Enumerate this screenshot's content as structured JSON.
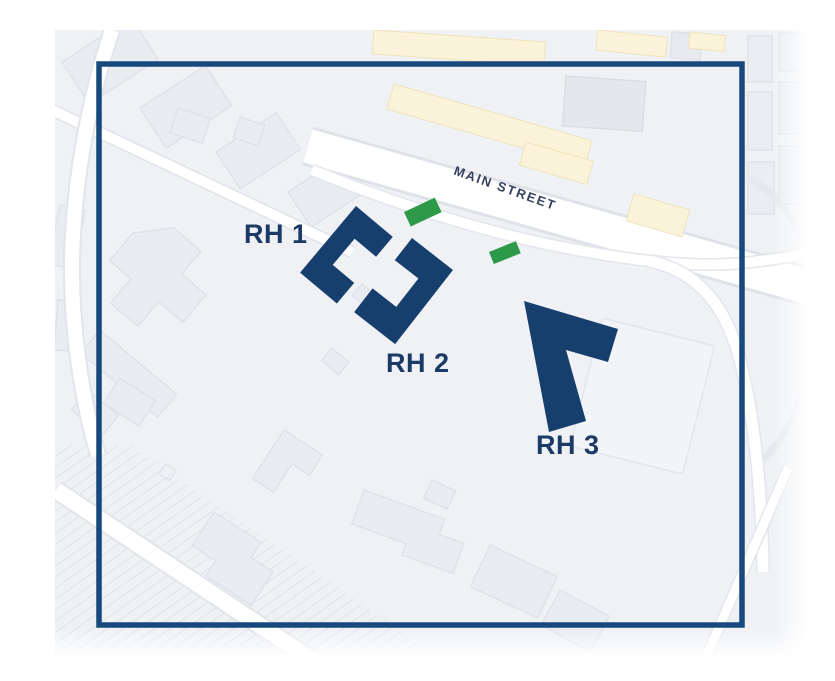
{
  "figure": {
    "type": "site-plan-map",
    "street": {
      "label": "MAIN STREET"
    },
    "buildings": [
      {
        "id": "RH1",
        "label": "RH 1"
      },
      {
        "id": "RH2",
        "label": "RH 2"
      },
      {
        "id": "RH3",
        "label": "RH 3"
      }
    ],
    "markers": [
      {
        "id": "green-marker-1",
        "color": "#2c9a48"
      },
      {
        "id": "green-marker-2",
        "color": "#2c9a48"
      }
    ],
    "colors": {
      "boundary_outline": "#17497c",
      "building_fill": "#173f6d",
      "building_label": "#1b3a66",
      "street_label": "#36425f",
      "marker_green": "#2c9a48",
      "highlight_yellow": "#faf3da",
      "map_background": "#eff1f5",
      "page_background": "#ffffff"
    }
  }
}
